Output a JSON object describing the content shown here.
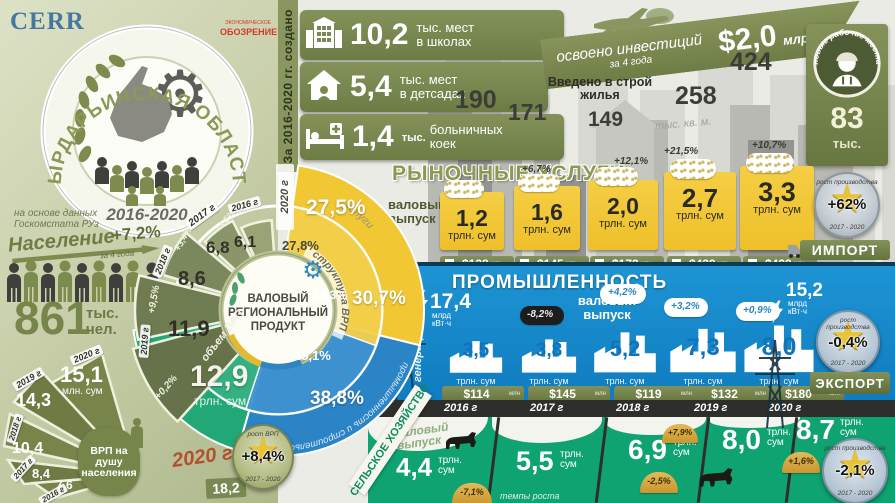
{
  "brand": {
    "cerr": "CERR",
    "mag1": "ЭКОНОМИЧЕСКОЕ",
    "mag2": "ОБОЗРЕНИЕ"
  },
  "emblem": {
    "title": "СЫРДАРЬИНСКАЯ ОБЛАСТЬ",
    "years": "2016-2020",
    "source1": "на основе данных",
    "source2": "Госкомстата РУз"
  },
  "created_label": "За 2016-2020 гг. создано",
  "social": {
    "items": [
      {
        "value": "10,2",
        "unit": "",
        "l1": "тыс. мест",
        "l2": "в школах"
      },
      {
        "value": "5,4",
        "unit": "",
        "l1": "тыс. мест",
        "l2": "в детсадах"
      },
      {
        "value": "1,4",
        "unit": "тыс.",
        "l1": "больничных",
        "l2": "коек"
      }
    ]
  },
  "investment": {
    "l1": "освоено инвестиций",
    "l2": "за 4 года",
    "amount": "$2,0",
    "unit": "млрд."
  },
  "housing": {
    "label1": "Введено в строй",
    "label2": "жилья",
    "unit": "тыс. кв. м.",
    "values": [
      "190",
      "171",
      "149",
      "258",
      "424"
    ]
  },
  "jobs": {
    "title": "новые рабочие места",
    "value": "83",
    "unit": "тыс."
  },
  "population": {
    "label": "Население",
    "growth": "+7,2%",
    "note": "за 4 года",
    "value": "861",
    "unit1": "тыс.",
    "unit2": "чел."
  },
  "grp": {
    "center1": "ВАЛОВЫЙ",
    "center2": "РЕГИОНАЛЬНЫЙ",
    "center3": "ПРОДУКТ",
    "volume_label": "объем ВРП",
    "structure_label": "структура ВРП",
    "ring_year": "2020 г",
    "year_label": "2020 г",
    "volume": [
      {
        "year": "2016 г",
        "value": "6,1",
        "growth": ""
      },
      {
        "year": "2017 г",
        "value": "6,8",
        "growth": "+4,5%"
      },
      {
        "year": "2018 г",
        "value": "8,6",
        "growth": "+3,4%"
      },
      {
        "year": "2019 г",
        "value": "11,9",
        "growth": "+9,5%"
      },
      {
        "year": "2020 г",
        "value": "12,9",
        "growth": "+0,2%",
        "unit": "трлн. сум"
      }
    ],
    "structure": [
      {
        "name": "услуги",
        "outer": "27,5%",
        "inner": "27,8%"
      },
      {
        "name": "промышленность и строительство",
        "outer": "30,7%",
        "inner": "24,3%"
      },
      {
        "name": "сельское хозяйство",
        "outer": "38,8%",
        "inner": "45,1%"
      }
    ],
    "medal": {
      "top": "рост ВРП",
      "value": "+8,4%",
      "bottom": "2017 - 2020"
    }
  },
  "per_capita": {
    "label1": "ВРП на душу",
    "label2": "населения",
    "extra": "18,2",
    "items": [
      {
        "year": "2016 г",
        "value": "7,6"
      },
      {
        "year": "2017 г",
        "value": "8,4"
      },
      {
        "year": "2018 г",
        "value": "10,4"
      },
      {
        "year": "2019 г",
        "value": "14,3"
      },
      {
        "year": "2020 г",
        "value": "15,1",
        "unit": "млн. сум"
      }
    ]
  },
  "market": {
    "title": "РЫНОЧНЫЕ УСЛУГИ",
    "output_l1": "валовый",
    "output_l2": "выпуск",
    "import_label": "ИМПОРТ",
    "mln": "млн",
    "items": [
      {
        "value": "1,2",
        "unit": "трлн. сум",
        "growth": "",
        "import": "$138"
      },
      {
        "value": "1,6",
        "unit": "трлн. сум",
        "growth": "+6,7%",
        "import": "$145"
      },
      {
        "value": "2,0",
        "unit": "трлн. сум",
        "growth": "+12,1%",
        "import": "$172"
      },
      {
        "value": "2,7",
        "unit": "трлн. сум",
        "growth": "+21,5%",
        "import": "$439"
      },
      {
        "value": "3,3",
        "unit": "трлн. сум",
        "growth": "+10,7%",
        "import": "$433"
      }
    ],
    "medal": {
      "top": "рост производства",
      "value": "+62%",
      "bottom": "2017 - 2020"
    }
  },
  "industry": {
    "title": "ПРОМЫШЛЕННОСТЬ",
    "output_l1": "валовый",
    "output_l2": "выпуск",
    "export_label": "ЭКСПОРТ",
    "mln": "млн",
    "generation_label": "генерация",
    "generation_value": "17,4",
    "gen_u1": "млрд",
    "gen_u2": "кВт·ч",
    "consumption_value": "15,2",
    "cons_u1": "млрд",
    "cons_u2": "кВт·ч",
    "items": [
      {
        "value": "3,5",
        "unit": "трлн. сум",
        "growth": "",
        "export": "$114"
      },
      {
        "value": "3,8",
        "unit": "трлн. сум",
        "growth": "-8,2%",
        "export": "$145"
      },
      {
        "value": "5,2",
        "unit": "трлн. сум",
        "growth": "+4,2%",
        "export": "$119"
      },
      {
        "value": "7,3",
        "unit": "трлн. сум",
        "growth": "+3,2%",
        "export": "$132"
      },
      {
        "value": "8,0",
        "unit": "трлн. сум",
        "growth": "+0,9%",
        "export": "$180"
      }
    ],
    "years": [
      "2016 г",
      "2017 г",
      "2018 г",
      "2019 г",
      "2020 г"
    ],
    "medal": {
      "top": "рост производства",
      "value": "-0,4%",
      "bottom": "2017 - 2020"
    }
  },
  "agriculture": {
    "ribbon": "сельское хозяйство",
    "output_l1": "валовый",
    "output_l2": "выпуск",
    "rate_label": "темпы роста",
    "items": [
      {
        "value": "4,4",
        "u1": "трлн.",
        "u2": "сум",
        "growth": "-7,1%"
      },
      {
        "value": "5,5",
        "u1": "трлн.",
        "u2": "сум",
        "growth": ""
      },
      {
        "value": "6,9",
        "u1": "трлн.",
        "u2": "сум",
        "growth": "-2,5%"
      },
      {
        "value": "8,0",
        "u1": "трлн.",
        "u2": "сум",
        "growth": "+7,9%"
      },
      {
        "value": "8,7",
        "u1": "трлн.",
        "u2": "сум",
        "growth": "+1,6%"
      }
    ],
    "medal": {
      "top": "рост производства",
      "value": "-2,1%",
      "bottom": "2017 - 2020"
    }
  },
  "chart_data": [
    {
      "type": "bar",
      "title": "Объем ВРП",
      "ylabel": "трлн. сум",
      "categories": [
        "2016",
        "2017",
        "2018",
        "2019",
        "2020"
      ],
      "values": [
        6.1,
        6.8,
        8.6,
        11.9,
        12.9
      ],
      "growth_pct": [
        null,
        4.5,
        3.4,
        9.5,
        0.2
      ],
      "total_growth": "+8,4% (2017-2020)"
    },
    {
      "type": "pie",
      "title": "Структура ВРП",
      "legend": [
        "услуги",
        "промышленность и строительство",
        "сельское хозяйство"
      ],
      "outer_ring_pct": [
        27.5,
        30.7,
        38.8
      ],
      "inner_ring_pct": [
        27.8,
        24.3,
        45.1
      ]
    },
    {
      "type": "bar",
      "title": "Рыночные услуги — валовый выпуск",
      "ylabel": "трлн. сум",
      "categories": [
        "2016",
        "2017",
        "2018",
        "2019",
        "2020"
      ],
      "values": [
        1.2,
        1.6,
        2.0,
        2.7,
        3.3
      ],
      "growth_pct": [
        null,
        6.7,
        12.1,
        21.5,
        10.7
      ],
      "import_musd": [
        138,
        145,
        172,
        439,
        433
      ],
      "total_growth": "+62% (2017-2020)"
    },
    {
      "type": "bar",
      "title": "Промышленность — валовый выпуск",
      "ylabel": "трлн. сум",
      "categories": [
        "2016",
        "2017",
        "2018",
        "2019",
        "2020"
      ],
      "values": [
        3.5,
        3.8,
        5.2,
        7.3,
        8.0
      ],
      "growth_pct": [
        null,
        -8.2,
        4.2,
        3.2,
        0.9
      ],
      "export_musd": [
        114,
        145,
        119,
        132,
        180
      ],
      "generation_bln_kwh": 17.4,
      "consumption_bln_kwh": 15.2,
      "total_growth": "-0,4% (2017-2020)"
    },
    {
      "type": "bar",
      "title": "Сельское хозяйство — валовый выпуск",
      "ylabel": "трлн. сум",
      "categories": [
        "2016",
        "2017",
        "2018",
        "2019",
        "2020"
      ],
      "values": [
        4.4,
        5.5,
        6.9,
        8.0,
        8.7
      ],
      "growth_pct": [
        -7.1,
        null,
        -2.5,
        7.9,
        1.6
      ],
      "total_growth": "-2,1% (2017-2020)"
    },
    {
      "type": "bar",
      "title": "ВРП на душу населения",
      "ylabel": "млн. сум",
      "categories": [
        "2016",
        "2017",
        "2018",
        "2019",
        "2020"
      ],
      "values": [
        7.6,
        8.4,
        10.4,
        14.3,
        15.1
      ]
    },
    {
      "type": "bar",
      "title": "Введено в строй жилья",
      "ylabel": "тыс. кв. м",
      "categories": [
        "2016",
        "2017",
        "2018",
        "2019",
        "2020"
      ],
      "values": [
        190,
        171,
        149,
        258,
        424
      ],
      "population_thousand": 861,
      "population_growth": "+7,2%",
      "new_jobs_thousand": 83,
      "investment_bln_usd": 2.0,
      "school_places_thousand": 10.2,
      "kindergarten_places_thousand": 5.4,
      "hospital_beds_thousand": 1.4
    }
  ]
}
